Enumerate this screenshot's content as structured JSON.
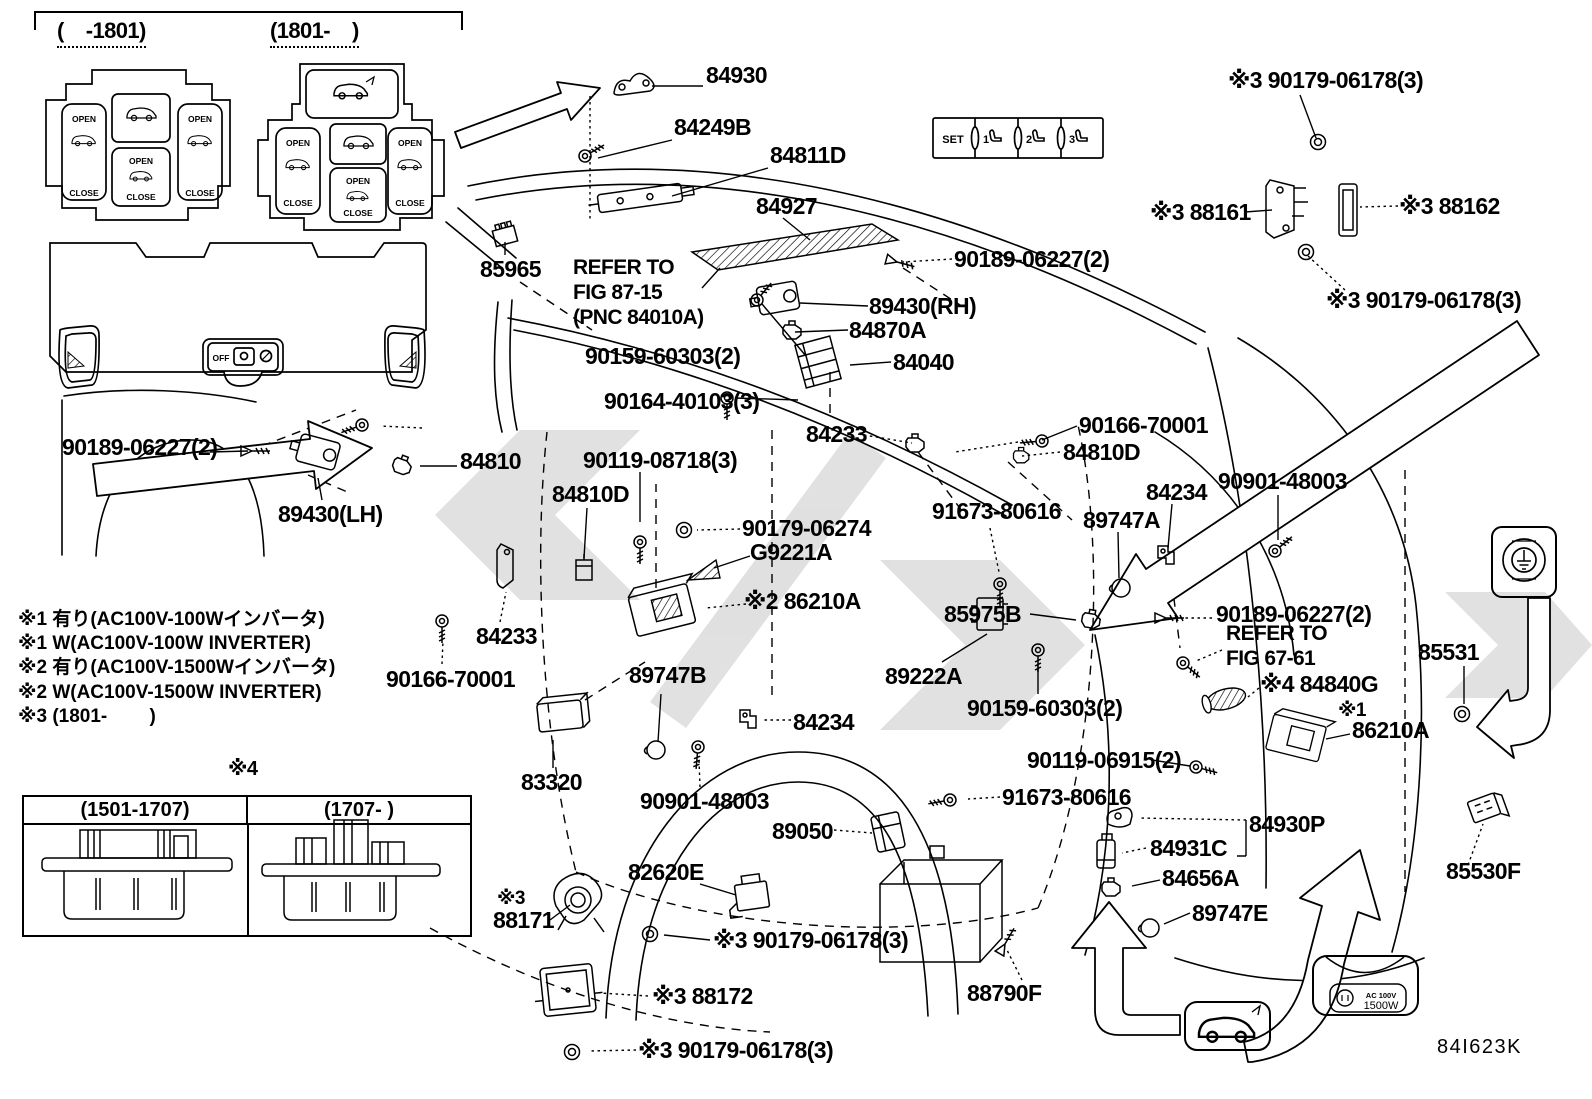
{
  "doc": {
    "diagram_code": "84I623K"
  },
  "insets": {
    "panelA": {
      "title": "(    -1801)",
      "open": "OPEN",
      "close": "CLOSE"
    },
    "panelB": {
      "title": "(1801-    )",
      "open": "OPEN",
      "close": "CLOSE"
    },
    "trim": {
      "off": "OFF"
    },
    "set_panel": {
      "cells": [
        "SET",
        "1",
        "2",
        "3"
      ]
    },
    "table4": {
      "tag": "#4",
      "col1": "(1501-1707)",
      "col2": "(1707-      )"
    },
    "ac_badge": {
      "line1": "AC 100V",
      "line2": "1500W"
    }
  },
  "icons": {
    "ground-icon": "earth-ground symbol in rounded square",
    "power-outlet-icon": "AC outlet plug",
    "car-hatch-icon": "vehicle with open back door",
    "seat-icon": "memory seat positions 1-2-3",
    "hatch-triangle-icon": "diagonal hatched triangle"
  },
  "notes": [
    "※1 有り(AC100V-100Wインバータ)",
    "※1 W(AC100V-100W INVERTER)",
    "※2 有り(AC100V-1500Wインバータ)",
    "※2 W(AC100V-1500W INVERTER)",
    "※3 (1801-        )"
  ],
  "labels": [
    {
      "t": "84930",
      "x": 706,
      "y": 64
    },
    {
      "t": "84249B",
      "x": 674,
      "y": 116
    },
    {
      "t": "84811D",
      "x": 770,
      "y": 144
    },
    {
      "t": "84927",
      "x": 756,
      "y": 195
    },
    {
      "t": "85965",
      "x": 480,
      "y": 258
    },
    {
      "t": "REFER TO",
      "x": 573,
      "y": 257,
      "fs": 21
    },
    {
      "t": "FIG 87-15",
      "x": 573,
      "y": 282,
      "fs": 21
    },
    {
      "t": "(PNC 84010A)",
      "x": 573,
      "y": 307,
      "fs": 21
    },
    {
      "t": "90159-60303(2)",
      "x": 585,
      "y": 345
    },
    {
      "t": "89430(RH)",
      "x": 869,
      "y": 295
    },
    {
      "t": "84870A",
      "x": 849,
      "y": 319
    },
    {
      "t": "84040",
      "x": 893,
      "y": 351
    },
    {
      "t": "90164-40103(3)",
      "x": 604,
      "y": 390
    },
    {
      "t": "84233",
      "x": 806,
      "y": 423
    },
    {
      "t": "90189-06227(2)",
      "x": 954,
      "y": 248
    },
    {
      "t": "※3 90179-06178(3)",
      "x": 1228,
      "y": 69
    },
    {
      "t": "※3 88161",
      "x": 1150,
      "y": 201
    },
    {
      "t": "※3 88162",
      "x": 1399,
      "y": 195
    },
    {
      "t": "※3 90179-06178(3)",
      "x": 1326,
      "y": 289
    },
    {
      "t": "90166-70001",
      "x": 1079,
      "y": 414
    },
    {
      "t": "84810D",
      "x": 1063,
      "y": 441
    },
    {
      "t": "90901-48003",
      "x": 1218,
      "y": 470
    },
    {
      "t": "84234",
      "x": 1146,
      "y": 481
    },
    {
      "t": "91673-80616",
      "x": 932,
      "y": 500
    },
    {
      "t": "89747A",
      "x": 1083,
      "y": 509
    },
    {
      "t": "85975B",
      "x": 944,
      "y": 603
    },
    {
      "t": "90189-06227(2)",
      "x": 1216,
      "y": 603
    },
    {
      "t": "REFER TO",
      "x": 1226,
      "y": 623,
      "fs": 21
    },
    {
      "t": "FIG 67-61",
      "x": 1226,
      "y": 648,
      "fs": 21
    },
    {
      "t": "※4 84840G",
      "x": 1260,
      "y": 673
    },
    {
      "t": "※1",
      "x": 1338,
      "y": 701,
      "fs": 19
    },
    {
      "t": "86210A",
      "x": 1352,
      "y": 719
    },
    {
      "t": "85531",
      "x": 1418,
      "y": 641
    },
    {
      "t": "89222A",
      "x": 885,
      "y": 665
    },
    {
      "t": "90159-60303(2)",
      "x": 967,
      "y": 697
    },
    {
      "t": "90119-06915(2)",
      "x": 1027,
      "y": 749
    },
    {
      "t": "91673-80616",
      "x": 1002,
      "y": 786
    },
    {
      "t": "84930P",
      "x": 1249,
      "y": 813
    },
    {
      "t": "84931C",
      "x": 1150,
      "y": 837
    },
    {
      "t": "84656A",
      "x": 1162,
      "y": 867
    },
    {
      "t": "89747E",
      "x": 1192,
      "y": 902
    },
    {
      "t": "88790F",
      "x": 967,
      "y": 982
    },
    {
      "t": "85530F",
      "x": 1446,
      "y": 860
    },
    {
      "t": "84I623K",
      "x": 1437,
      "y": 1037,
      "fs": 20,
      "w": "n",
      "ls": 1.5
    },
    {
      "t": "90189-06227(2)",
      "x": 62,
      "y": 436
    },
    {
      "t": "84810",
      "x": 460,
      "y": 450
    },
    {
      "t": "89430(LH)",
      "x": 278,
      "y": 503
    },
    {
      "t": "84810D",
      "x": 552,
      "y": 483
    },
    {
      "t": "90119-08718(3)",
      "x": 583,
      "y": 449
    },
    {
      "t": "90179-06274",
      "x": 742,
      "y": 517
    },
    {
      "t": "G9221A",
      "x": 750,
      "y": 541
    },
    {
      "t": "※2 86210A",
      "x": 744,
      "y": 590
    },
    {
      "t": "84233",
      "x": 476,
      "y": 625
    },
    {
      "t": "90166-70001",
      "x": 386,
      "y": 668
    },
    {
      "t": "89747B",
      "x": 629,
      "y": 664
    },
    {
      "t": "84234",
      "x": 793,
      "y": 711
    },
    {
      "t": "83320",
      "x": 521,
      "y": 771
    },
    {
      "t": "90901-48003",
      "x": 640,
      "y": 790
    },
    {
      "t": "89050",
      "x": 772,
      "y": 820
    },
    {
      "t": "82620E",
      "x": 628,
      "y": 861
    },
    {
      "t": "※3",
      "x": 497,
      "y": 889,
      "fs": 19
    },
    {
      "t": "88171",
      "x": 493,
      "y": 909
    },
    {
      "t": "※3 90179-06178(3)",
      "x": 713,
      "y": 929
    },
    {
      "t": "※3 88172",
      "x": 652,
      "y": 985
    },
    {
      "t": "※3 90179-06178(3)",
      "x": 638,
      "y": 1039
    },
    {
      "t": "(    -1801)",
      "x": 57,
      "y": 20,
      "fs": 22,
      "u": 1
    },
    {
      "t": "(1801-    )",
      "x": 270,
      "y": 20,
      "fs": 22,
      "u": 1
    },
    {
      "t": "※4",
      "x": 228,
      "y": 759,
      "fs": 20
    }
  ]
}
